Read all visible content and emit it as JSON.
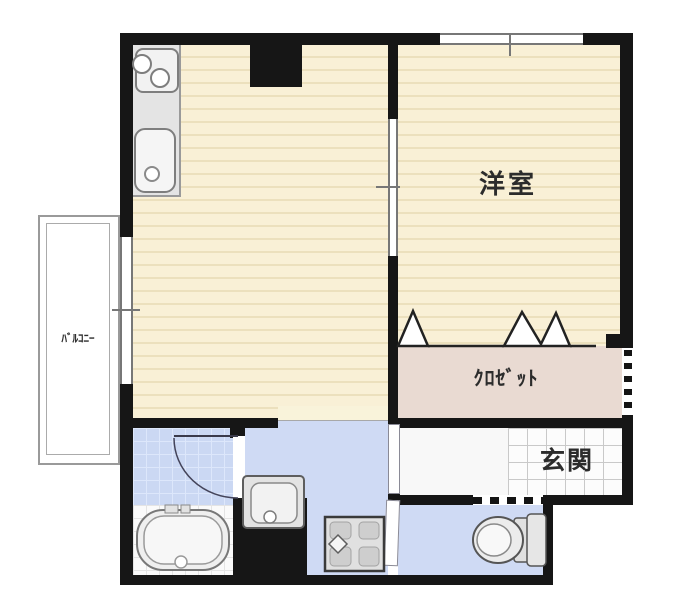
{
  "floorplan": {
    "type": "japanese-apartment-1k-floorplan",
    "rooms": {
      "western_room": {
        "label": "洋室"
      },
      "closet": {
        "label": "ｸﾛｾﾞｯﾄ"
      },
      "entrance": {
        "label": "玄関"
      },
      "balcony": {
        "label": "ﾊﾞﾙｺﾆｰ"
      }
    },
    "fixtures": {
      "kitchen": "two-burner-stove-and-sink-counter",
      "bath": "bathtub",
      "sanitary": "washbasin",
      "laundry": "washing-machine-pan",
      "wc": "toilet",
      "closet_door": "accordion-folding-door",
      "front_door": "dashed-entry-door"
    },
    "colors": {
      "wall": "#161616",
      "wood_floor": "#f9f0d6",
      "wood_stripe": "#ece0bd",
      "closet_floor": "#e9dad2",
      "bath_tile": "#cbd8f3",
      "bath_tile_grid": "#dde7fb",
      "corridor_floor": "#cfdaf4",
      "entrance_tile": "#fcfcfc",
      "entrance_tile_grid": "#c9c9c9",
      "fixture_fill": "#ececec",
      "fixture_stroke": "#6e6e6e"
    }
  }
}
